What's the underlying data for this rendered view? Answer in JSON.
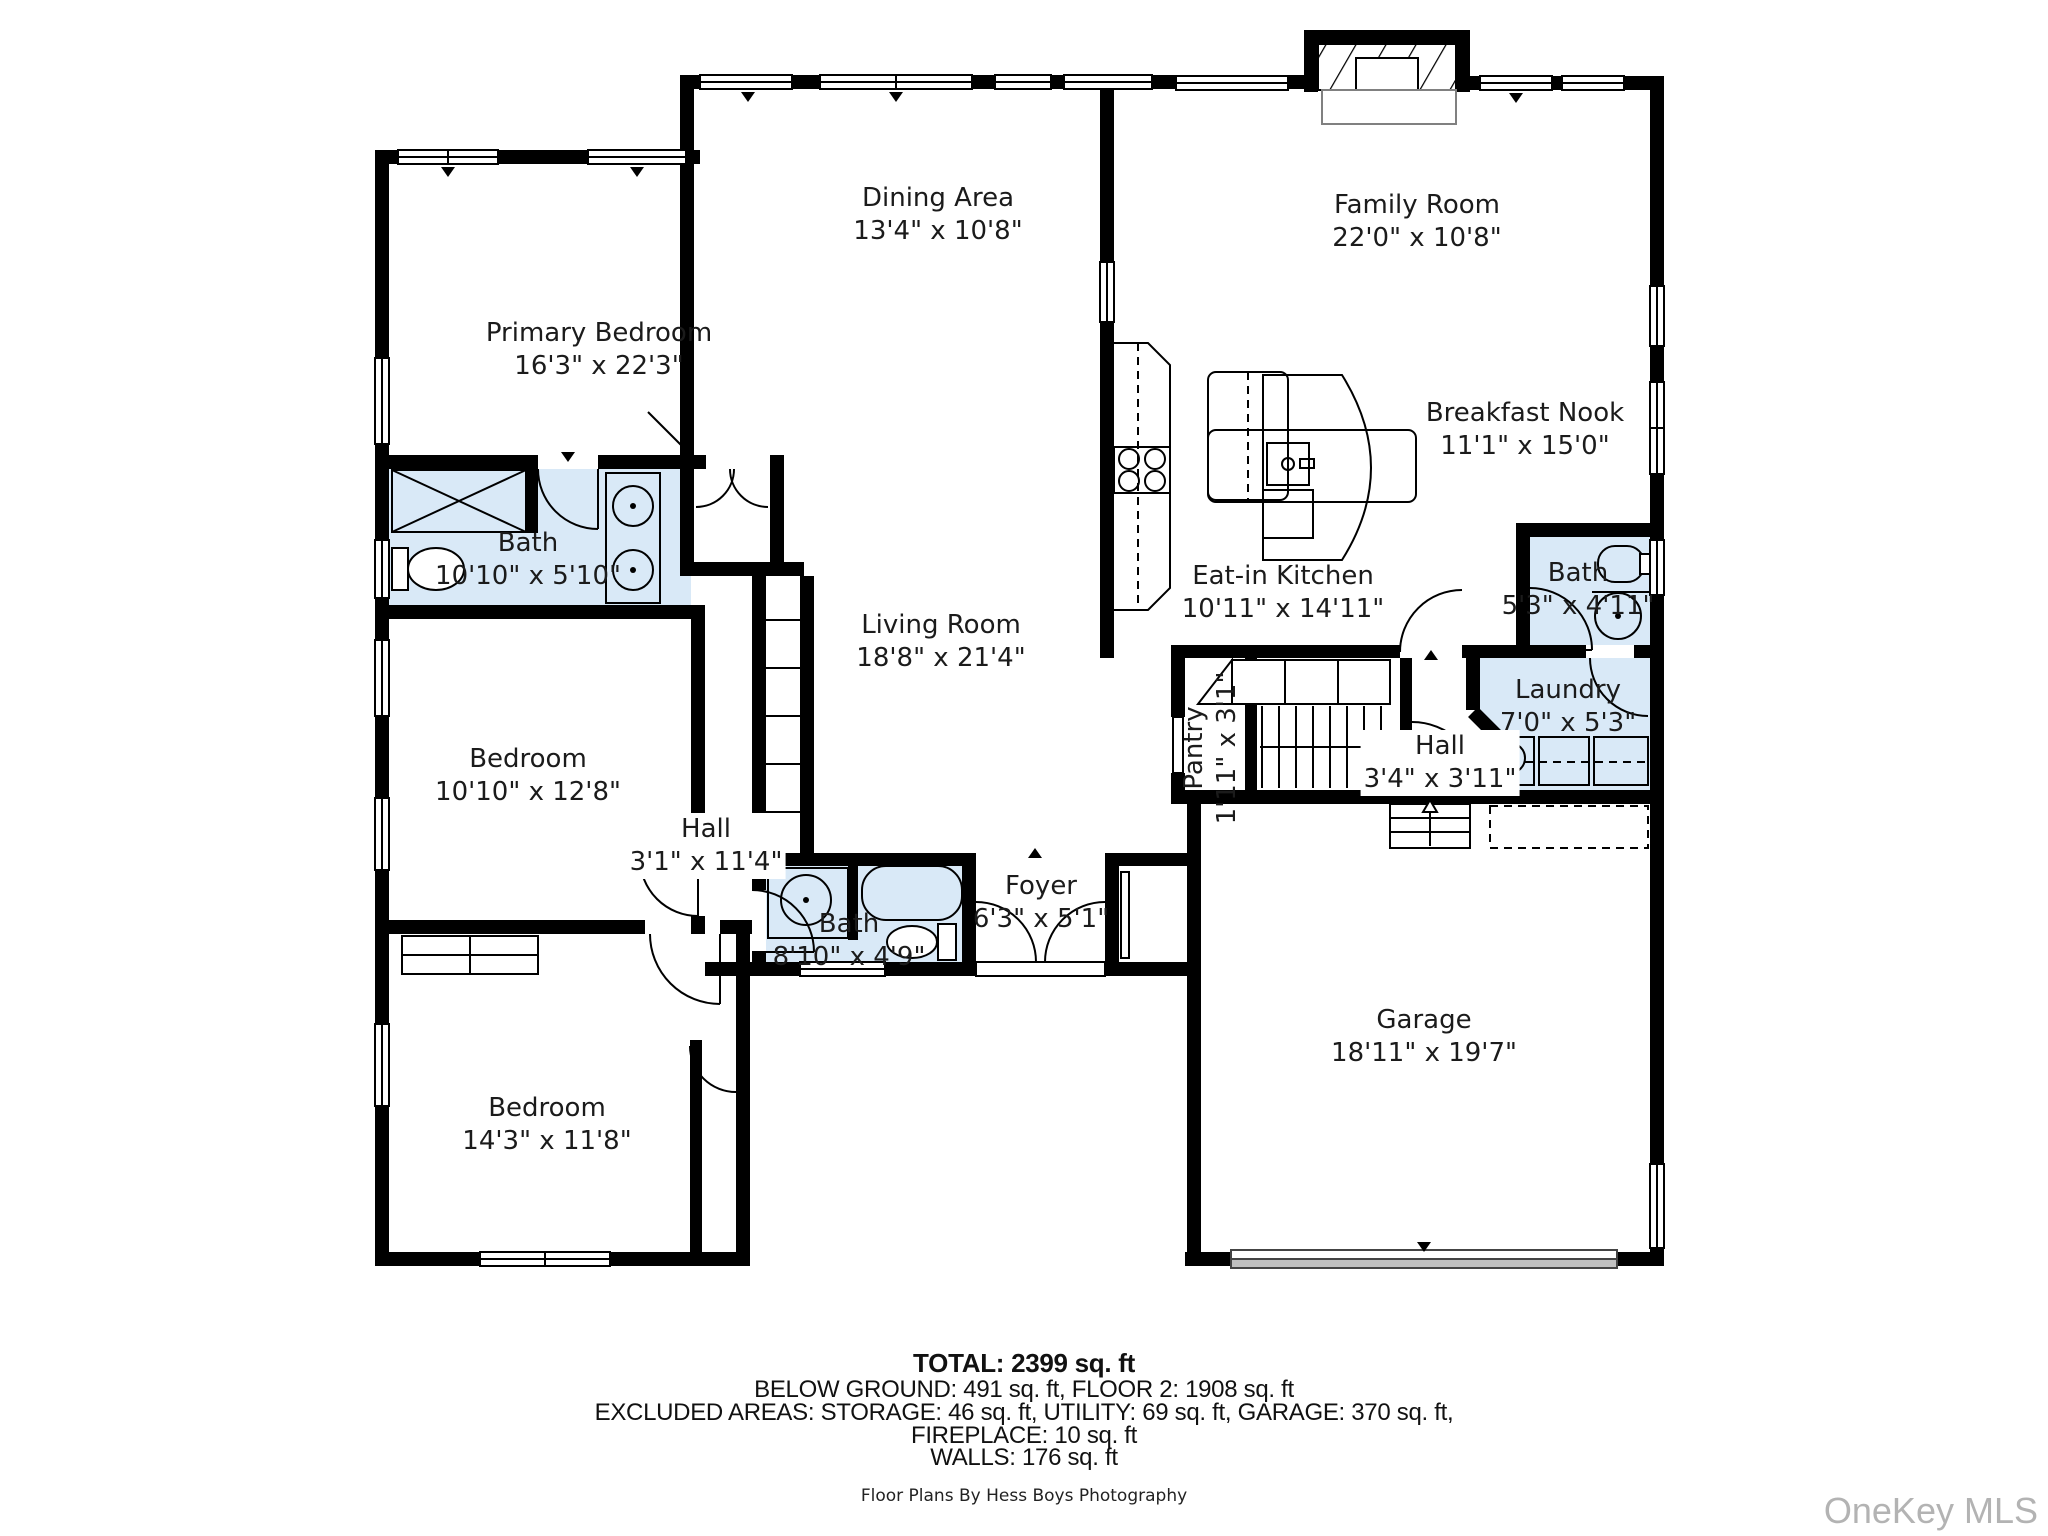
{
  "floor_plan": {
    "rooms": [
      {
        "name": "Dining Area",
        "dims": "13'4\" x 10'8\""
      },
      {
        "name": "Family Room",
        "dims": "22'0\" x 10'8\""
      },
      {
        "name": "Primary Bedroom",
        "dims": "16'3\" x 22'3\""
      },
      {
        "name": "Breakfast Nook",
        "dims": "11'1\" x 15'0\""
      },
      {
        "name": "Bath",
        "dims": "10'10\" x 5'10\""
      },
      {
        "name": "Eat-in Kitchen",
        "dims": "10'11\" x 14'11\""
      },
      {
        "name": "Bath",
        "dims": "5'3\" x 4'11\""
      },
      {
        "name": "Living Room",
        "dims": "18'8\" x 21'4\""
      },
      {
        "name": "Laundry",
        "dims": "7'0\" x 5'3\""
      },
      {
        "name": "Bedroom",
        "dims": "10'10\" x 12'8\""
      },
      {
        "name": "Pantry",
        "dims": "1'11\" x 3'1\""
      },
      {
        "name": "Hall",
        "dims": "3'4\" x 3'11\""
      },
      {
        "name": "Hall",
        "dims": "3'1\" x 11'4\""
      },
      {
        "name": "Bath",
        "dims": "8'10\" x 4'9\""
      },
      {
        "name": "Foyer",
        "dims": "6'3\" x 5'1\""
      },
      {
        "name": "Garage",
        "dims": "18'11\" x 19'7\""
      },
      {
        "name": "Bedroom",
        "dims": "14'3\" x 11'8\""
      }
    ],
    "footer": {
      "total": "TOTAL: 2399 sq. ft",
      "line2": "BELOW GROUND: 491 sq. ft, FLOOR 2: 1908 sq. ft",
      "line3": "EXCLUDED AREAS: STORAGE: 46 sq. ft, UTILITY: 69 sq. ft, GARAGE: 370 sq. ft,",
      "line4": "FIREPLACE: 10 sq. ft",
      "line5": "WALLS: 176 sq. ft"
    },
    "credit": "Floor Plans By Hess Boys Photography",
    "watermark": "OneKey MLS",
    "colors": {
      "wall": "#000000",
      "wet_room_fill": "#d9e9f7",
      "garage_door": "#c0c0c0",
      "watermark_gray": "#b3b3b3"
    }
  }
}
